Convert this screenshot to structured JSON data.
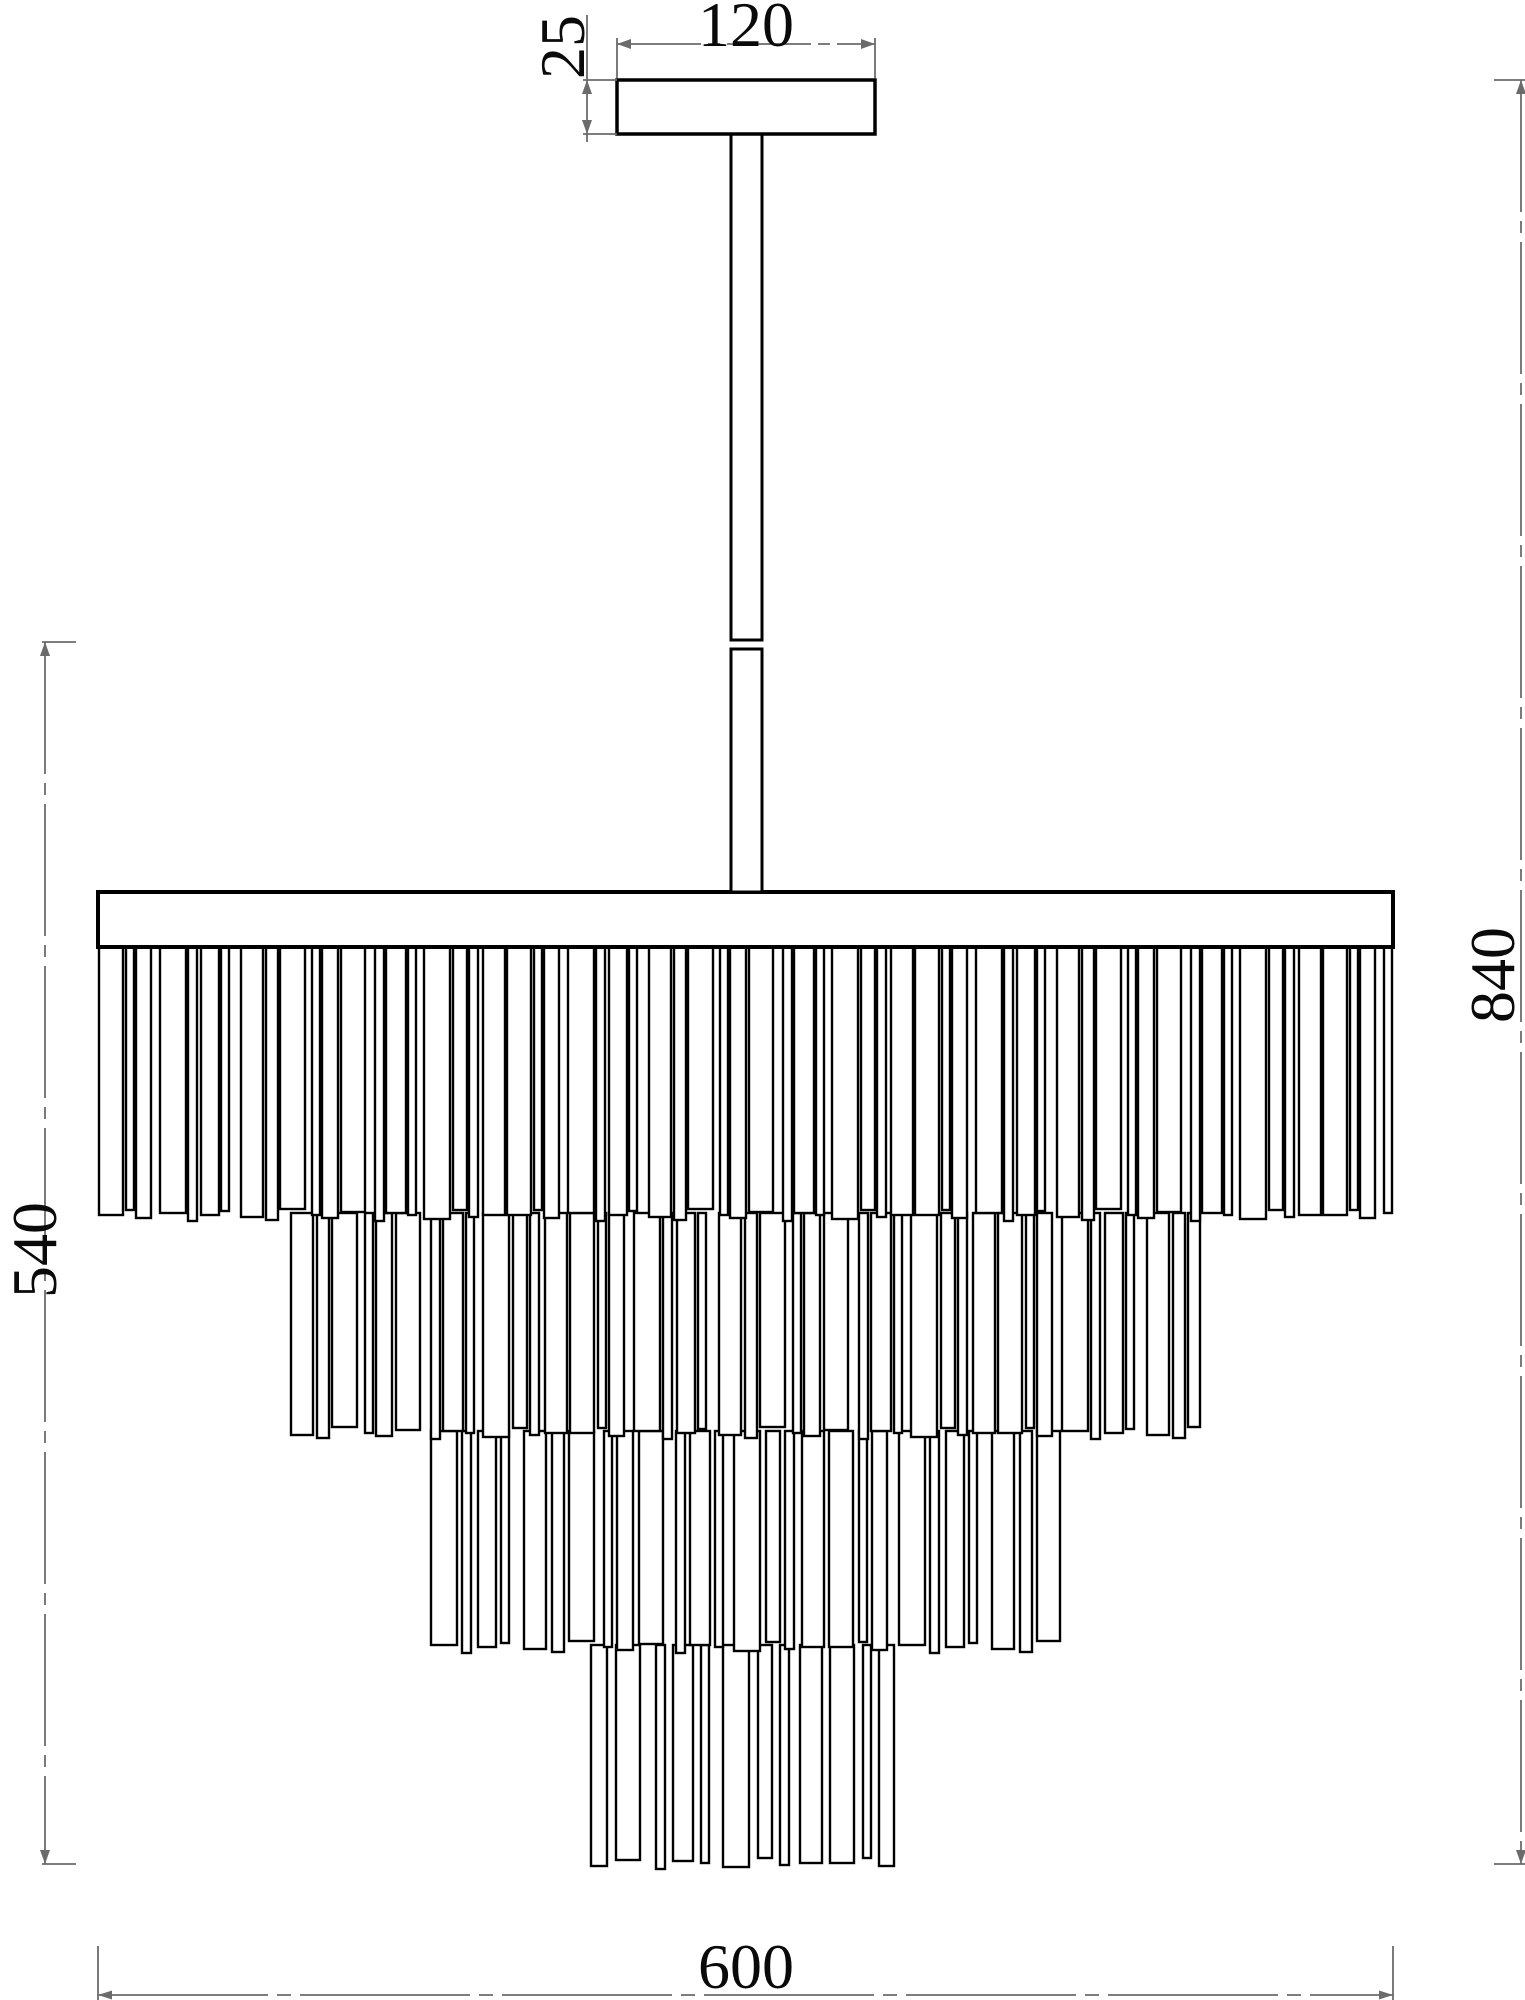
{
  "dimensions": {
    "canopy_width": "120",
    "canopy_height": "25",
    "fringe_height": "540",
    "total_height": "840",
    "body_diameter": "600"
  },
  "colors": {
    "object_line": "#000000",
    "dimension_line": "#6b6b6b",
    "text": "#0a0a0a",
    "background": "#ffffff"
  },
  "drawing": {
    "canvas": {
      "w": 1525,
      "h": 2000
    },
    "canopy": {
      "x": 617,
      "y": 80,
      "w": 258,
      "h": 54,
      "sw": 3.5
    },
    "rod": {
      "x": 731,
      "w": 31,
      "top": 134,
      "joint_top": 640,
      "joint_bottom": 649,
      "bottom": 892,
      "sw": 3
    },
    "plate": {
      "x": 98,
      "y": 892,
      "w": 1295,
      "h": 55,
      "sw": 4
    },
    "tiers": [
      {
        "left": 98,
        "right": 1393,
        "top": 944,
        "bottom": 1215,
        "offset": 0,
        "gap_boost": 0
      },
      {
        "left": 290,
        "right": 1201,
        "top": 1213,
        "bottom": 1433,
        "offset": 7,
        "gap_boost": 1
      },
      {
        "left": 430,
        "right": 1061,
        "top": 1431,
        "bottom": 1647,
        "offset": 3,
        "gap_boost": 3
      },
      {
        "left": 590,
        "right": 901,
        "top": 1645,
        "bottom": 1863,
        "offset": 11,
        "gap_boost": 6
      }
    ],
    "strip_widths": [
      24,
      8,
      15,
      26,
      9,
      18,
      8,
      22,
      12,
      25,
      8,
      16,
      24,
      9,
      20,
      8,
      26,
      14,
      9,
      22
    ],
    "strip_gaps": [
      3,
      2,
      9,
      2,
      4,
      2,
      12,
      3,
      2,
      7,
      2,
      3,
      10,
      2,
      2,
      8,
      3,
      2,
      5,
      2
    ],
    "bottom_jitter": [
      0,
      -5,
      3,
      -2,
      6,
      0,
      -4,
      2,
      5,
      -6,
      0,
      3,
      -3,
      6,
      -2,
      0,
      4,
      -5,
      2,
      0
    ],
    "dim_lines": [
      {
        "x1": 587,
        "y1": 15,
        "x2": 587,
        "y2": 142
      },
      {
        "x1": 617,
        "y1": 44,
        "x2": 875,
        "y2": 44,
        "dash": "84 7 12 7"
      },
      {
        "x1": 45,
        "y1": 642,
        "x2": 45,
        "y2": 1864,
        "dash": "132 9 12 9"
      },
      {
        "x1": 1521,
        "y1": 80,
        "x2": 1521,
        "y2": 1864,
        "dash": "132 9 12 9"
      },
      {
        "x1": 98,
        "y1": 1995,
        "x2": 1393,
        "y2": 1995,
        "dash": "170 9 14 9"
      }
    ],
    "dim_ticks": [
      {
        "x1": 583,
        "y1": 80,
        "x2": 617,
        "y2": 80
      },
      {
        "x1": 583,
        "y1": 134,
        "x2": 617,
        "y2": 134
      },
      {
        "x1": 617,
        "y1": 38,
        "x2": 617,
        "y2": 78
      },
      {
        "x1": 875,
        "y1": 38,
        "x2": 875,
        "y2": 78
      },
      {
        "x1": 42,
        "y1": 642,
        "x2": 76,
        "y2": 642
      },
      {
        "x1": 42,
        "y1": 1864,
        "x2": 76,
        "y2": 1864
      },
      {
        "x1": 1494,
        "y1": 80,
        "x2": 1525,
        "y2": 80
      },
      {
        "x1": 1494,
        "y1": 1864,
        "x2": 1525,
        "y2": 1864
      },
      {
        "x1": 98,
        "y1": 1946,
        "x2": 98,
        "y2": 2000
      },
      {
        "x1": 1393,
        "y1": 1946,
        "x2": 1393,
        "y2": 2000
      }
    ],
    "dim_arrows": [
      "M587 80 L582 94 L592 94 Z",
      "M587 134 L582 120 L592 120 Z",
      "M617 44 L631 39 L631 49 Z",
      "M875 44 L861 39 L861 49 Z",
      "M45 642 L40 656 L50 656 Z",
      "M45 1864 L40 1850 L50 1850 Z",
      "M1521 80 L1516 94 L1526 94 Z",
      "M1521 1864 L1516 1850 L1526 1850 Z",
      "M98 1995 L112 1990.5 L112 1999.5 Z",
      "M1393 1995 L1379 1990.5 L1379 1999.5 Z"
    ]
  }
}
